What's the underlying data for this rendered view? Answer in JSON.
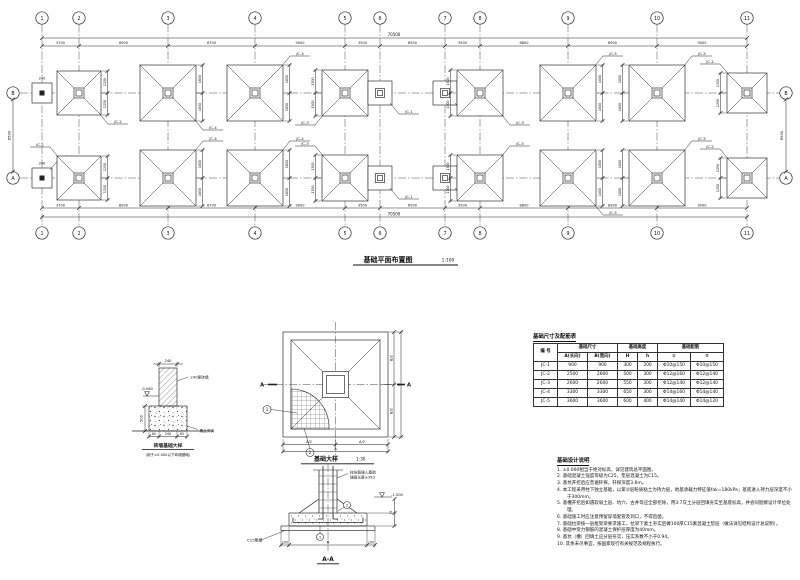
{
  "plan": {
    "title": "基础平面布置图",
    "scale": "1:100",
    "overall_dim": "70500",
    "row_dim": "8500",
    "wall_dim": "240",
    "seg_dims": [
      "3700",
      "8900",
      "8700",
      "9000",
      "3500",
      "6500",
      "3500",
      "8800",
      "8900",
      "9000"
    ],
    "cols": [
      {
        "n": "1",
        "x": 42
      },
      {
        "n": "2",
        "x": 79
      },
      {
        "n": "3",
        "x": 168
      },
      {
        "n": "4",
        "x": 255
      },
      {
        "n": "5",
        "x": 345
      },
      {
        "n": "6",
        "x": 380
      },
      {
        "n": "7",
        "x": 445
      },
      {
        "n": "8",
        "x": 480
      },
      {
        "n": "9",
        "x": 568
      },
      {
        "n": "10",
        "x": 657
      },
      {
        "n": "11",
        "x": 747
      }
    ],
    "rows": [
      {
        "n": "B",
        "y": 93
      },
      {
        "n": "A",
        "y": 178
      }
    ],
    "footings": [
      {
        "c": 0,
        "r": 0,
        "t": "w"
      },
      {
        "c": 1,
        "r": 0,
        "t": "x",
        "s": 44,
        "lb": "JC-2",
        "lp": "br",
        "dm": [
          "1250",
          "1250"
        ],
        "ds": "r"
      },
      {
        "c": 2,
        "r": 0,
        "t": "x",
        "s": 56,
        "lb": "JC-4",
        "lp": "br",
        "dm": [
          "1650",
          "1650"
        ],
        "ds": "r"
      },
      {
        "c": 3,
        "r": 0,
        "t": "x",
        "s": 56,
        "lb": "JC-4",
        "lp": "tr",
        "dm": [
          "1650",
          "1650"
        ],
        "ds": "r"
      },
      {
        "c": 4,
        "r": 0,
        "t": "x",
        "s": 46,
        "lb": "JC-3",
        "lp": "bl",
        "dm": [
          "1300",
          "1300"
        ],
        "ds": "l"
      },
      {
        "c": 5,
        "r": 0,
        "t": "s",
        "lb": "JC-1",
        "lp": "br"
      },
      {
        "c": 6,
        "r": 0,
        "t": "s",
        "lb": "JC-1",
        "lp": "br"
      },
      {
        "c": 7,
        "r": 0,
        "t": "x",
        "s": 46,
        "lb": "JC-3",
        "lp": "br",
        "dm": [
          "1300",
          "1300"
        ],
        "ds": "l"
      },
      {
        "c": 8,
        "r": 0,
        "t": "x",
        "s": 56,
        "lb": "JC-5",
        "lp": "tr",
        "dm": [
          "1800",
          "1800"
        ],
        "ds": "r"
      },
      {
        "c": 9,
        "r": 0,
        "t": "x",
        "s": 56,
        "lb": "JC-5",
        "lp": "tr",
        "dm": [
          "1800",
          "1800"
        ],
        "ds": "l"
      },
      {
        "c": 10,
        "r": 0,
        "t": "x",
        "s": 40,
        "lb": "JC-2",
        "lp": "tl",
        "dm": [
          "1250",
          "1250"
        ],
        "ds": "l"
      },
      {
        "c": 0,
        "r": 1,
        "t": "w",
        "lb": "TJ-1",
        "lp": "tr"
      },
      {
        "c": 1,
        "r": 1,
        "t": "x",
        "s": 44,
        "lb": "JC-2",
        "lp": "tl",
        "dm": [
          "1250",
          "1250"
        ],
        "ds": "r"
      },
      {
        "c": 2,
        "r": 1,
        "t": "x",
        "s": 56,
        "lb": "JC-4",
        "lp": "tr",
        "dm": [
          "1650",
          "1650"
        ],
        "ds": "r"
      },
      {
        "c": 3,
        "r": 1,
        "t": "x",
        "s": 56,
        "lb": "JC-4",
        "lp": "tr",
        "dm": [
          "1650",
          "1650"
        ],
        "ds": "r"
      },
      {
        "c": 4,
        "r": 1,
        "t": "x",
        "s": 46,
        "lb": "JC-3",
        "lp": "tl",
        "dm": [
          "1300",
          "1300"
        ],
        "ds": "l"
      },
      {
        "c": 5,
        "r": 1,
        "t": "s",
        "lb": "JC-1",
        "lp": "br"
      },
      {
        "c": 6,
        "r": 1,
        "t": "s",
        "lb": "JC-1",
        "lp": "br"
      },
      {
        "c": 7,
        "r": 1,
        "t": "x",
        "s": 46,
        "lb": "JC-3",
        "lp": "tr",
        "dm": [
          "1300",
          "1300"
        ],
        "ds": "l"
      },
      {
        "c": 8,
        "r": 1,
        "t": "x",
        "s": 56,
        "lb": "JC-5",
        "lp": "br",
        "dm": [
          "1800",
          "1800"
        ],
        "ds": "r"
      },
      {
        "c": 9,
        "r": 1,
        "t": "x",
        "s": 56,
        "lb": "JC-5",
        "lp": "tr",
        "dm": [
          "1800",
          "1800"
        ],
        "ds": "l"
      },
      {
        "c": 10,
        "r": 1,
        "t": "x",
        "s": 40,
        "lb": "JC-2",
        "lp": "tl",
        "dm": [
          "1250",
          "1250"
        ],
        "ds": "l"
      }
    ]
  },
  "detail": {
    "caption": "基础大样",
    "scale": "1:30",
    "section_mark": "A",
    "callouts": [
      "1",
      "2"
    ],
    "dims": {
      "right": [
        "B/2",
        "B/2"
      ],
      "right_overall": "B",
      "bottom": [
        "A/2",
        "A/2"
      ],
      "bottom_overall": "A"
    }
  },
  "section": {
    "caption": "A-A",
    "col_note_1": "柱纵筋锚入基础",
    "col_note_2": "锚固长度≥35d",
    "bedding_note": "C15垫层",
    "level": "-1.500",
    "callouts": [
      "1",
      "2"
    ],
    "dims": {
      "bottom": [
        "100",
        "B",
        "100"
      ],
      "right_total": "H"
    }
  },
  "wall_detail": {
    "top_dim": "240",
    "wall_note": "240厚砖墙",
    "level": "-0.060",
    "height_dim": "500",
    "ground_note": "素土夯实",
    "bottom_dims": [
      "60",
      "240",
      "60"
    ],
    "caption": "砖墙基础大样",
    "caption_note": "(用于±0.000以下砖墙基础)"
  },
  "table": {
    "title": "基础尺寸及配筋表",
    "h1": {
      "id": "编 号",
      "size": "基础尺寸",
      "height": "基础高度",
      "rebar": "基础配筋"
    },
    "h2": {
      "a": "A(长向)",
      "b": "B(宽向)",
      "H": "H",
      "h": "h",
      "r1": "①",
      "r2": "②"
    },
    "rows": [
      [
        "JC-1",
        "900",
        "900",
        "300",
        "200",
        "Φ10@150",
        "Φ10@150"
      ],
      [
        "JC-2",
        "2500",
        "2600",
        "500",
        "300",
        "Φ12@160",
        "Φ12@140"
      ],
      [
        "JC-3",
        "2600",
        "2600",
        "550",
        "300",
        "Φ12@140",
        "Φ12@140"
      ],
      [
        "JC-4",
        "3300",
        "3300",
        "650",
        "300",
        "Φ14@160",
        "Φ14@140"
      ],
      [
        "JC-5",
        "3600",
        "3600",
        "600",
        "400",
        "Φ14@140",
        "Φ14@120"
      ]
    ]
  },
  "notes": {
    "title": "基础设计说明",
    "items": [
      "1. ±0.000相当于绝对标高，详见建筑总平面图。",
      "2. 基础混凝土强度等级为C25，垫层混凝土为C15。",
      "3. 基坑开挖后应普遍钎探，钎探深度3.6m。",
      "4. 本工程采用柱下独立基础，以第②层粉质粘土为持力层，地基承载力特征值fak=180kPa；基底进入持力层深度不小于300mm。",
      "5. 基槽开挖后如遇软弱土层、坑穴、古井等应全部挖除，用3:7灰土分层回填夯实至基底标高，并会同勘察设计单位处理。",
      "6. 基础施工时应注意预留穿墙套管及洞口，不得后凿。",
      "7. 基础拉梁按一层框架梁要求施工，拉梁下素土夯实后做100厚C15素混凝土垫层（做法详见结构设计总说明）。",
      "8. 基础中受力钢筋的混凝土保护层厚度为40mm。",
      "9. 基坑（槽）回填土应分层夯实，压实系数不小于0.94。",
      "10. 其余未尽事宜，按国家现行有关规范及规程执行。"
    ]
  }
}
